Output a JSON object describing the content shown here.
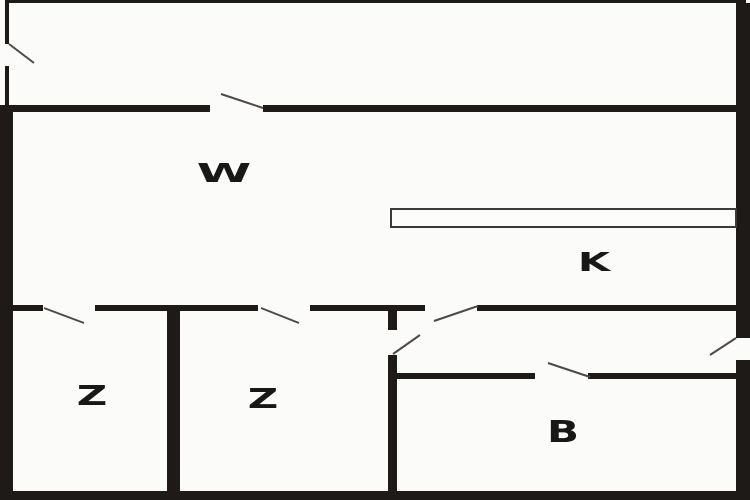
{
  "diagram_type": "floor-plan",
  "colors": {
    "background": "#fbfbf9",
    "wall": "#1e1a17",
    "door_swing_line": "#4f4a47",
    "label_text": "#181818",
    "counter_border": "#3b3b3b"
  },
  "rooms": {
    "w": {
      "label": "W"
    },
    "k": {
      "label": "K"
    },
    "z1": {
      "label": "Z"
    },
    "z2": {
      "label": "Z"
    },
    "b": {
      "label": "B"
    }
  },
  "features": {
    "door_count": 8,
    "counter": "kitchen-counter"
  }
}
